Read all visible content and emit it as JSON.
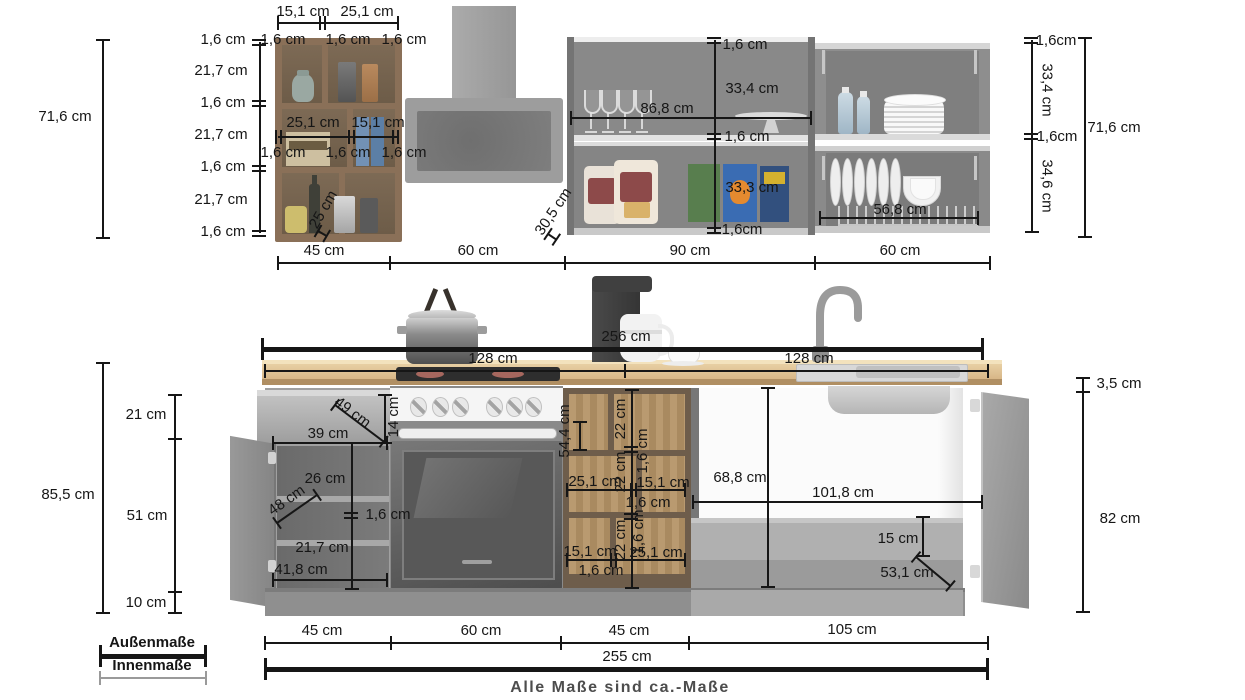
{
  "dims": {
    "tl": {
      "height": "71,6 cm",
      "col": [
        "1,6 cm",
        "21,7 cm",
        "1,6 cm",
        "21,7 cm",
        "1,6 cm",
        "21,7 cm",
        "1,6 cm"
      ],
      "topw": [
        "15,1 cm",
        "25,1 cm"
      ],
      "topg": [
        "1,6 cm",
        "1,6 cm",
        "1,6 cm"
      ],
      "midw": [
        "25,1 cm",
        "15,1 cm"
      ],
      "midg": [
        "1,6 cm",
        "1,6 cm",
        "1,6 cm"
      ],
      "depth": "25 cm"
    },
    "widths_top": [
      "45 cm",
      "60 cm",
      "90 cm",
      "60 cm"
    ],
    "ms": {
      "t": "1,6 cm",
      "u": "33,4 cm",
      "w": "86,8 cm",
      "m": "1,6 cm",
      "l": "33,3 cm",
      "b": "1,6cm",
      "depth": "30,5 cm"
    },
    "ru": {
      "t": "1,6cm",
      "u": "33,4 cm",
      "m": "1,6cm",
      "l": "34,6 cm",
      "inner": "56,8 cm",
      "height": "71,6 cm"
    },
    "counter": {
      "total": "256 cm",
      "left": "128 cm",
      "right": "128 cm"
    },
    "bl": {
      "height": "85,5 cm",
      "segs": [
        "21 cm",
        "51 cm",
        "10 cm"
      ],
      "diag": "49 cm",
      "dw": "39 cm",
      "dh": "14 cm",
      "shelf": "26 cm",
      "depth": "48 cm",
      "gap": "1,6 cm",
      "lower": "21,7 cm",
      "inner": "41,8 cm"
    },
    "bm": {
      "height": "54,4 cm",
      "v": [
        "22 cm",
        "1,6 cm",
        "22 cm",
        "1,6 cm",
        "22 cm"
      ],
      "r1": [
        "25,1 cm",
        "15,1 cm"
      ],
      "g1": "1,6 cm",
      "r2": [
        "15,1 cm",
        "25,1 cm"
      ],
      "g2": "1,6 cm"
    },
    "br": {
      "height": "68,8 cm",
      "inner": "101,8 cm",
      "plinth": "15 cm",
      "diag": "53,1 cm",
      "top": "3,5 cm",
      "door": "82 cm"
    },
    "widths_bottom": [
      "45 cm",
      "60 cm",
      "45 cm",
      "105 cm"
    ],
    "total_bottom": "255 cm"
  },
  "legend": {
    "outer": "Außenmaße",
    "inner": "Innenmaße"
  },
  "footer": {
    "note": "Alle Maße sind ca.-Maße"
  },
  "colors": {
    "line": "#161616",
    "inner_line": "#9a9a9a",
    "wood": "#8a7058",
    "counter": "#d8b587",
    "cabinet": "#8a8a8a"
  }
}
